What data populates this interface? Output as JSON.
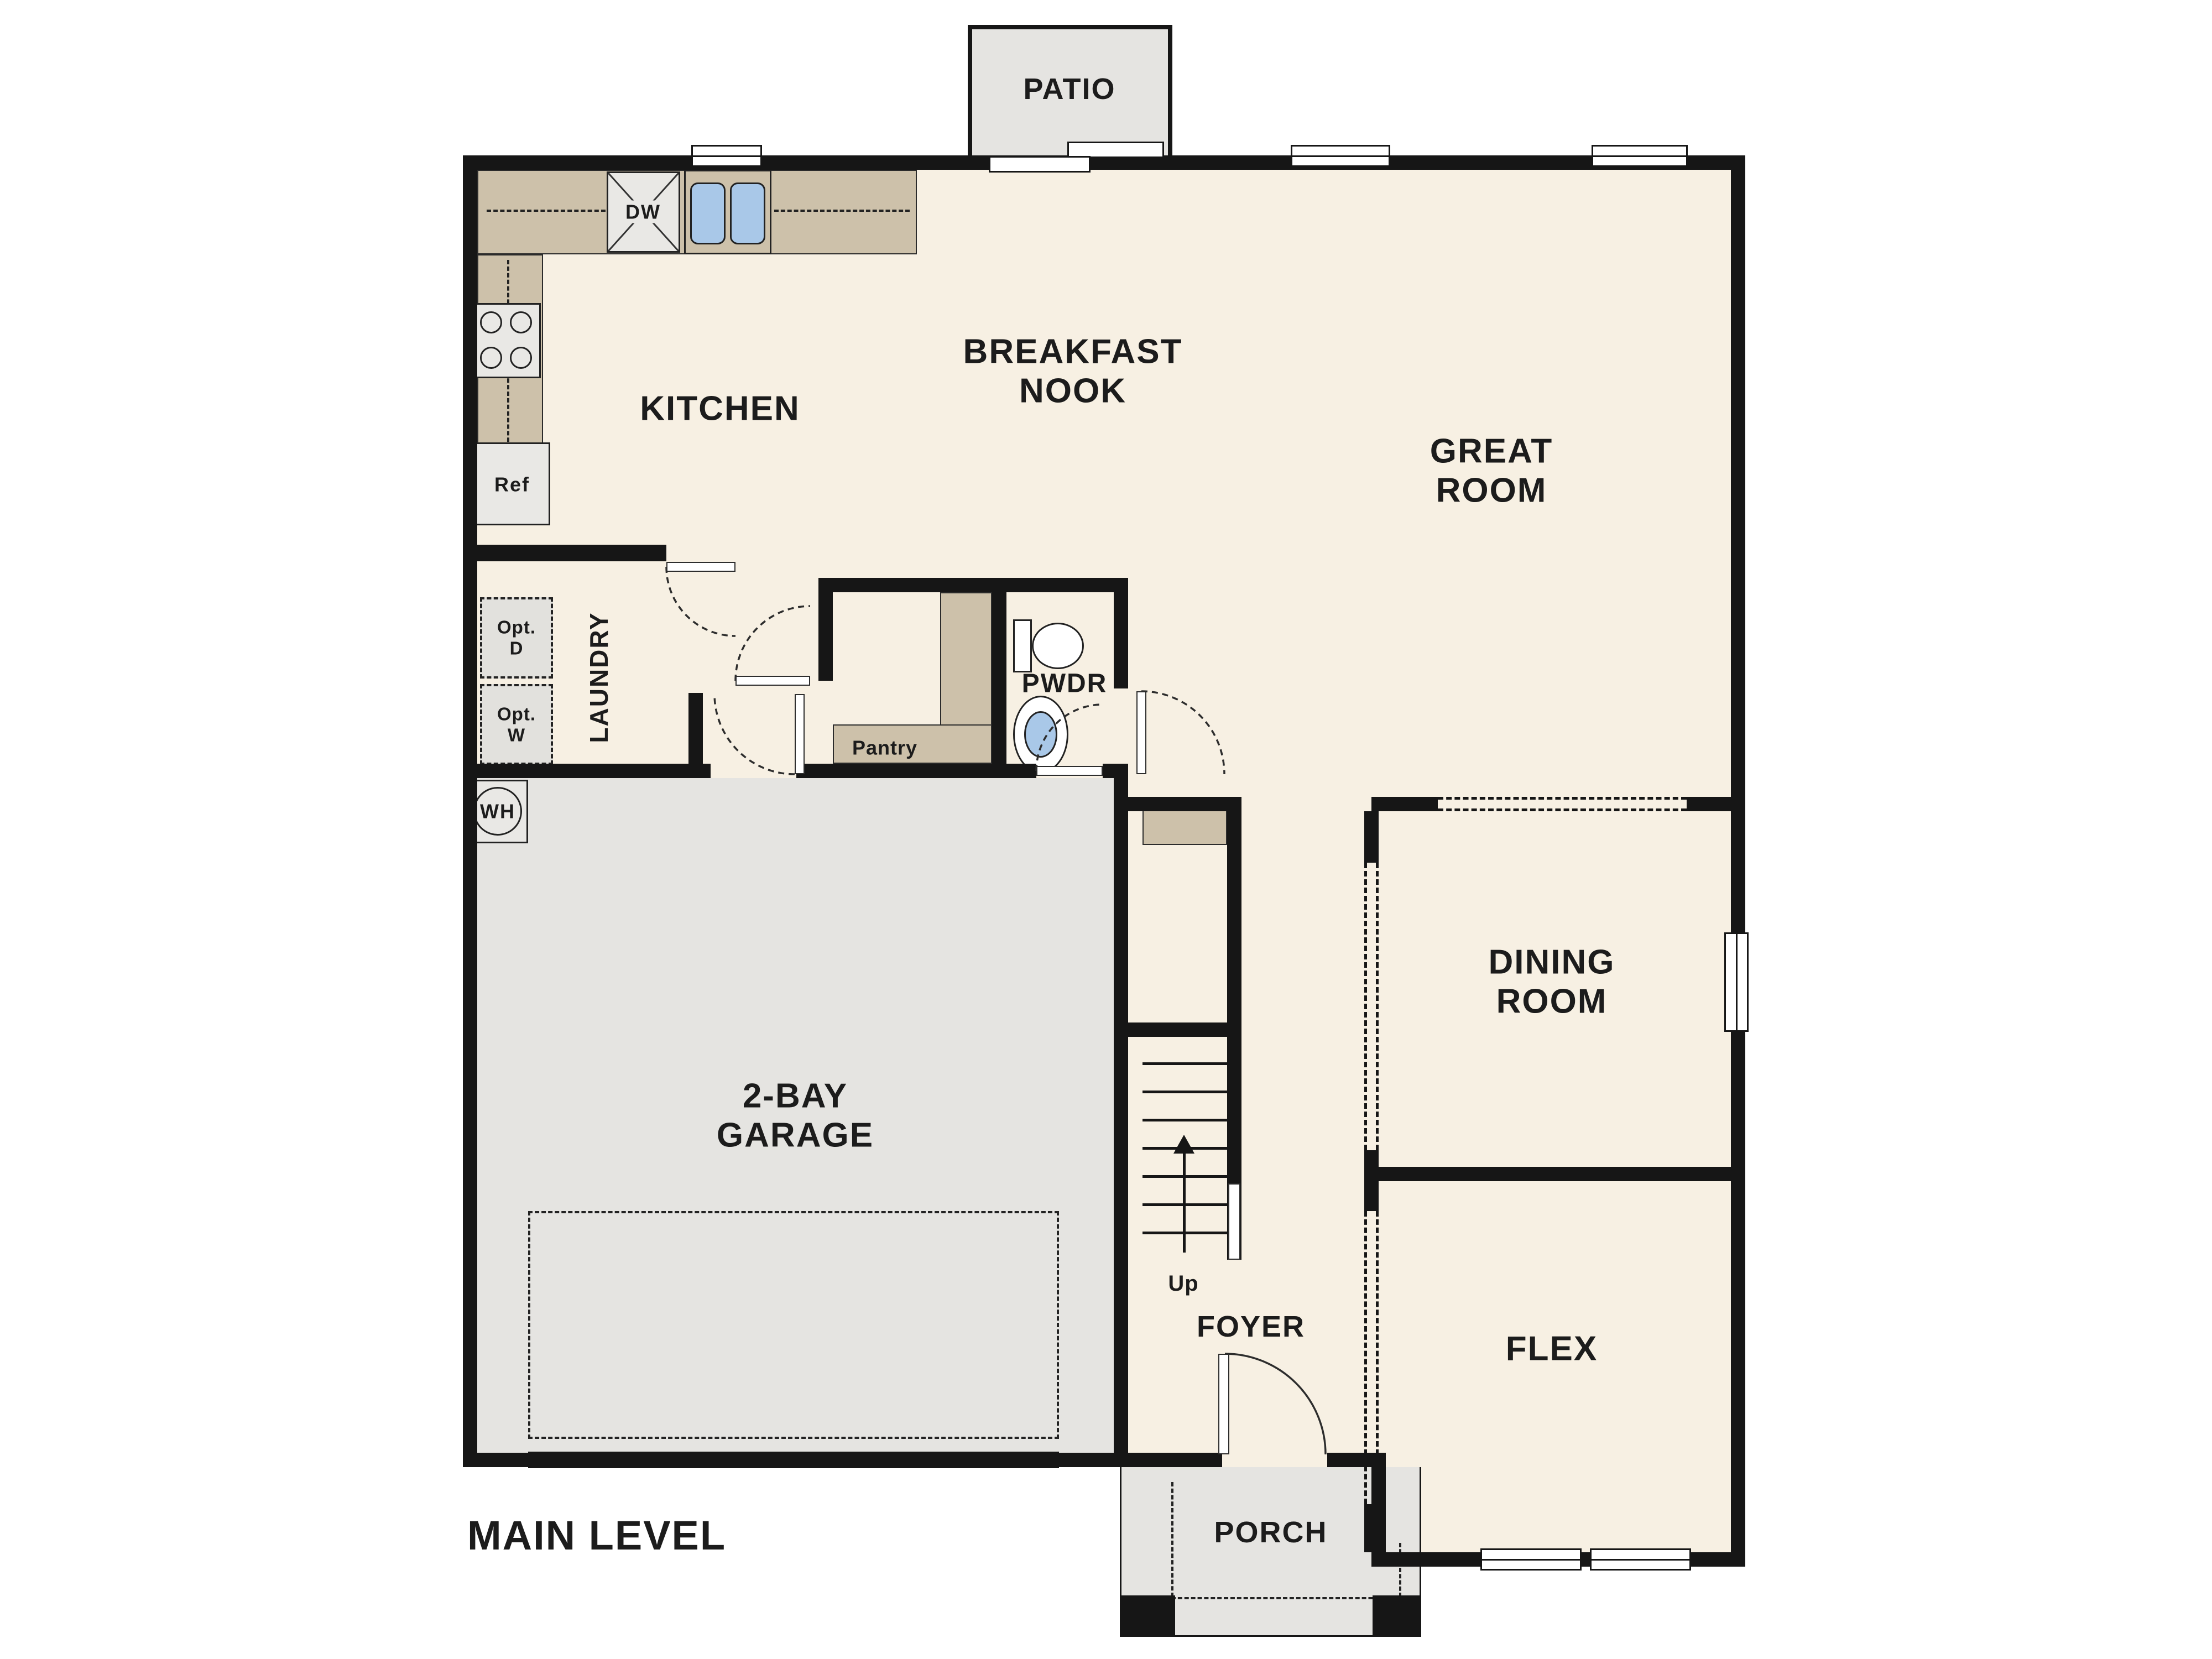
{
  "title": "MAIN LEVEL",
  "labels": {
    "patio": "PATIO",
    "breakfast_nook": "BREAKFAST\nNOOK",
    "kitchen": "KITCHEN",
    "great_room": "GREAT\nROOM",
    "laundry": "LAUNDRY",
    "pwdr": "PWDR",
    "pantry": "Pantry",
    "dining_room": "DINING\nROOM",
    "garage": "2-BAY\nGARAGE",
    "flex": "FLEX",
    "foyer": "FOYER",
    "porch": "PORCH",
    "up": "Up",
    "main_level": "MAIN LEVEL"
  },
  "fixtures": {
    "dishwasher": "DW",
    "refrigerator": "Ref",
    "water_heater": "WH",
    "optional_dryer": "Opt.\nD",
    "optional_washer": "Opt.\nW"
  },
  "colors": {
    "wall": "#161616",
    "floor_cream": "#f7f0e3",
    "hardscape_gray": "#e5e4e1",
    "counter_tan": "#cdc1aa",
    "sink_blue": "#a9c8e8",
    "text": "#1c1c1c",
    "background": "#ffffff"
  }
}
